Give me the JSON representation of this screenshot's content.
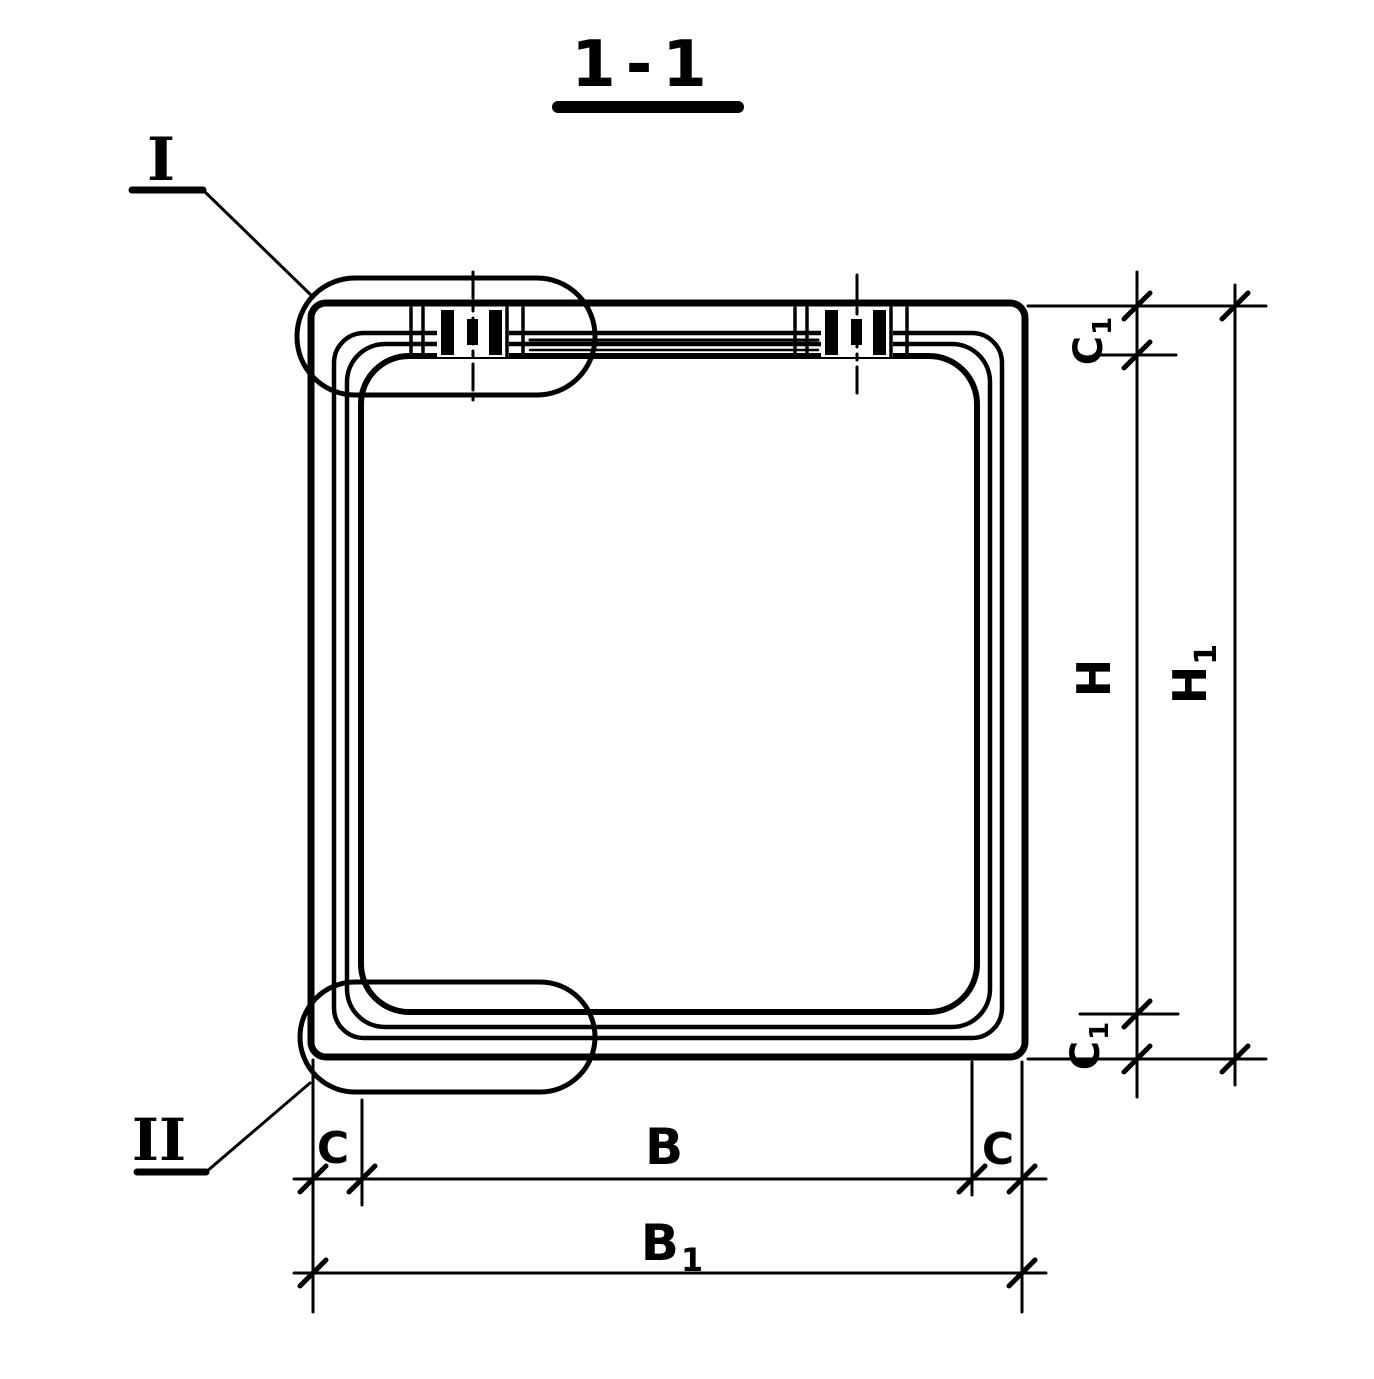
{
  "drawing": {
    "title": "1-1",
    "detail_labels": {
      "top": "I",
      "bottom": "II"
    },
    "dimension_labels": {
      "c1_top": {
        "base": "C",
        "sub": "1"
      },
      "h": {
        "base": "H",
        "sub": ""
      },
      "h1": {
        "base": "H",
        "sub": "1"
      },
      "c1_bottom": {
        "base": "C",
        "sub": "1"
      },
      "c_left": {
        "base": "C",
        "sub": ""
      },
      "b": {
        "base": "B",
        "sub": ""
      },
      "c_right": {
        "base": "C",
        "sub": ""
      },
      "b1": {
        "base": "B",
        "sub": "1"
      }
    },
    "colors": {
      "ink": "#000000",
      "paper": "#ffffff"
    }
  }
}
